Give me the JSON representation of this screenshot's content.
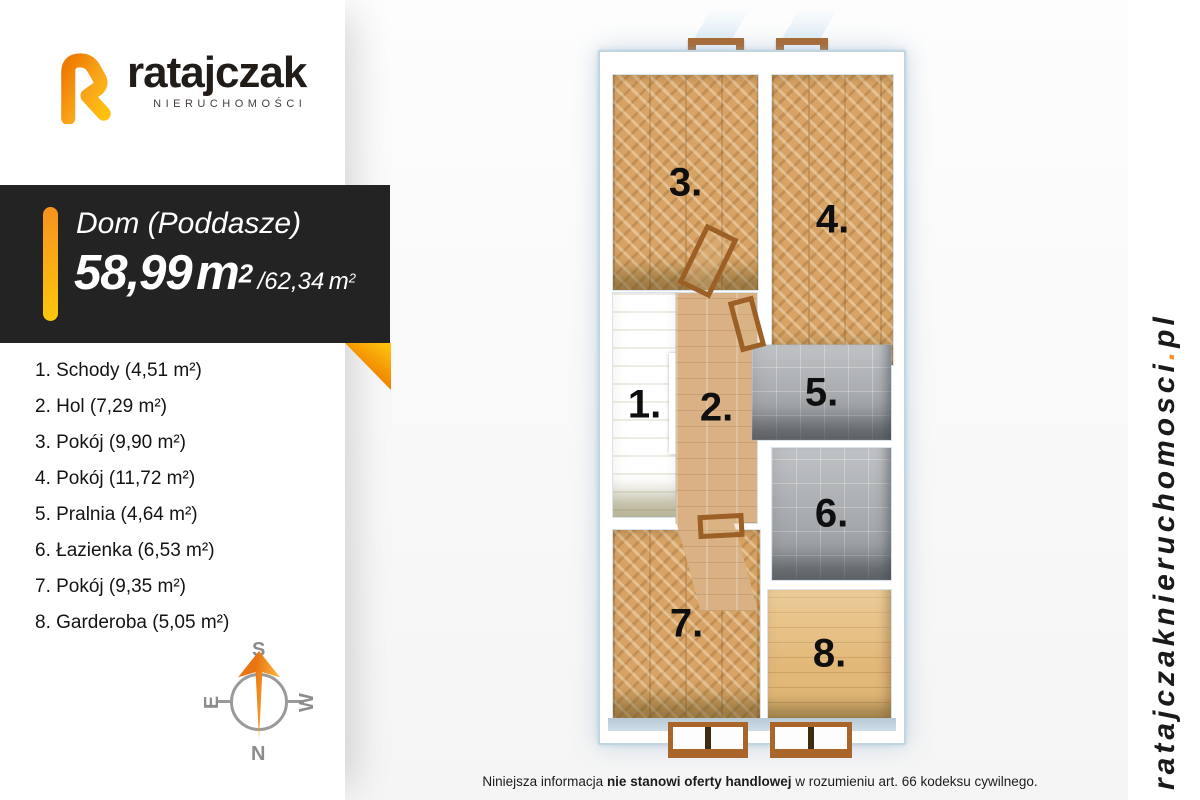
{
  "branding": {
    "logo_text": "ratajczak",
    "logo_subtext": "NIERUCHOMOŚCI",
    "website": {
      "domain": "ratajczaknieruchomosci",
      "dot": ".",
      "tld": "pl"
    }
  },
  "banner": {
    "title": "Dom (Poddasze)",
    "area": {
      "value": "58,99",
      "unit": "m",
      "sup": "2",
      "alt_value": "/62,34",
      "alt_unit": "m",
      "alt_sup": "2"
    }
  },
  "legend": {
    "items": [
      "1. Schody (4,51 m²)",
      "2. Hol (7,29 m²)",
      "3. Pokój (9,90 m²)",
      "4. Pokój (11,72 m²)",
      "5. Pralnia (4,64 m²)",
      "6. Łazienka (6,53 m²)",
      "7. Pokój (9,35 m²)",
      "8. Garderoba (5,05 m²)"
    ]
  },
  "compass": {
    "n": "N",
    "s": "S",
    "e": "E",
    "w": "W"
  },
  "plan": {
    "rooms": {
      "r1": "1.",
      "r2": "2.",
      "r3": "3.",
      "r4": "4.",
      "r5": "5.",
      "r6": "6.",
      "r7": "7.",
      "r8": "8."
    }
  },
  "footer": {
    "pre": "Niniejsza informacja ",
    "bold": "nie stanowi oferty handlowej",
    "post": " w rozumieniu art. 66 kodeksu cywilnego."
  },
  "colors": {
    "accent_orange": "#f7941e",
    "accent_yellow": "#fdc70c",
    "banner_bg": "#232323"
  }
}
